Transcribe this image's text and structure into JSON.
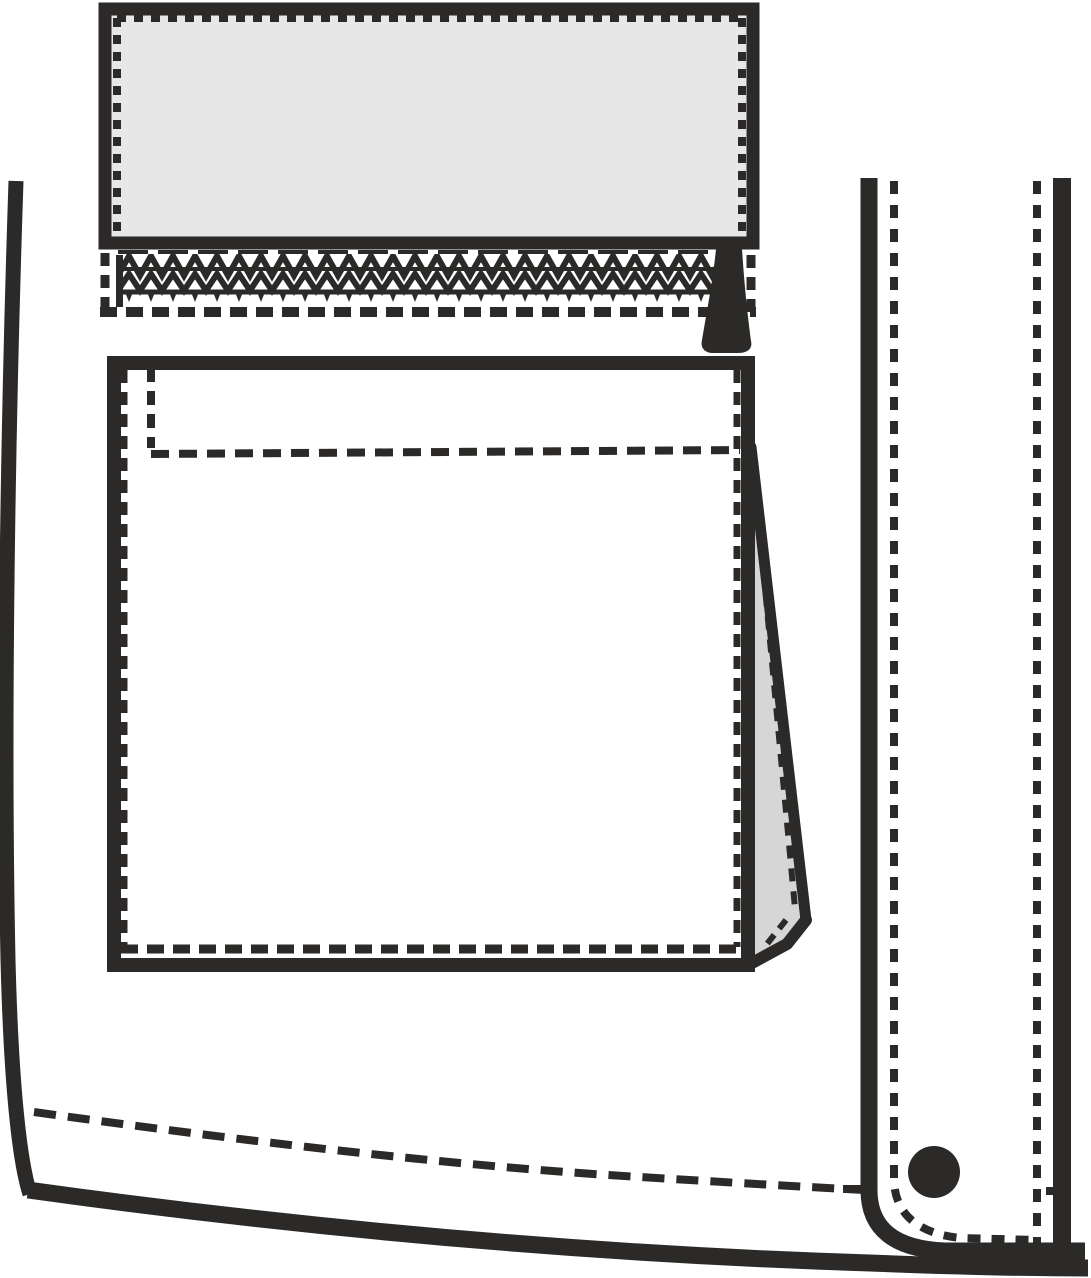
{
  "document": {
    "kind": "technical-flat-sketch",
    "subject": "jacket front detail: zip opening with flap, gusseted patch pocket, snap placket, curved hem"
  },
  "colors": {
    "ink": "#2b2a28",
    "background": "#ffffff",
    "flap_fill": "#e7e7e7",
    "gusset_fill": "#d6d6d6"
  },
  "parts": {
    "flap": "pocket flap with topstitching",
    "zipper": "zipper teeth band with slider pull",
    "pocket": "patch pocket with folded side gusset",
    "placket": "front placket with topstitching",
    "snap": "snap button",
    "side_seam": "left side seam",
    "hem": "curved bottom hem with topstitch"
  }
}
